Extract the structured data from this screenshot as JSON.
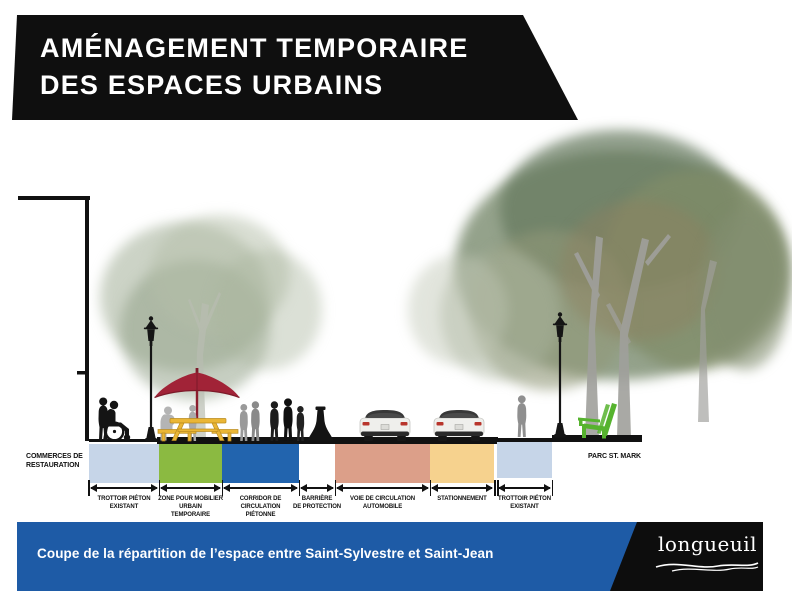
{
  "header": {
    "title_line1": "AMÉNAGEMENT TEMPORAIRE",
    "title_line2": "DES ESPACES URBAINS"
  },
  "diagram": {
    "left_annotation": "COMMERCES DE\nRESTAURATION",
    "right_annotation": "PARC ST. MARK",
    "zones": [
      {
        "label": "TROTTOIR PIÉTON\nEXISTANT",
        "color": "#c6d5e8"
      },
      {
        "label": "ZONE POUR MOBILIER\nURBAIN\nTEMPORAIRE",
        "color": "#8bba41"
      },
      {
        "label": "CORRIDOR DE\nCIRCULATION\nPIÉTONNE",
        "color": "#2264ae"
      },
      {
        "label": "BARRIÈRE\nDE PROTECTION",
        "color": "#ffffff"
      },
      {
        "label": "VOIE DE CIRCULATION\nAUTOMOBILE",
        "color": "#dc9f89"
      },
      {
        "label": "STATIONNEMENT",
        "color": "#f6d28e"
      },
      {
        "label": "TROTTOIR PIÉTON\nEXISTANT",
        "color": "#c6d5e8"
      }
    ]
  },
  "footer": {
    "caption": "Coupe de la répartition de l’espace entre Saint-Sylvestre et Saint-Jean",
    "logo_text": "longueuil"
  },
  "colors": {
    "banner_bg": "#0f0f0f",
    "footer_bar": "#1e5ba6",
    "logo_bg": "#0d0d0d",
    "umbrella_red": "#a12337",
    "table_yellow": "#eab636",
    "chair_green": "#56b32e",
    "ink": "#111111",
    "traffic_arrow_gray": "#9b9b9b"
  }
}
